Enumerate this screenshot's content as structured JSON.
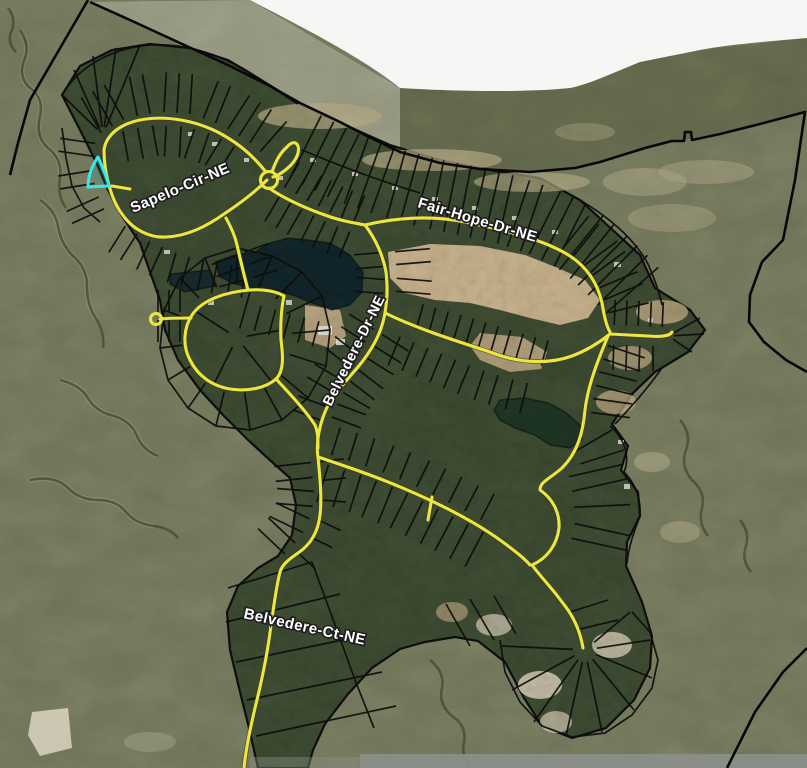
{
  "map": {
    "kind": "aerial-parcel-map",
    "labels": {
      "sapelo": "Sapelo-Cir-NE",
      "fair_hope": "Fair-Hope-Dr-NE",
      "belvedere_dr": "Belvedere-Dr-NE",
      "belvedere_ct": "Belvedere-Ct-NE"
    },
    "highlight": {
      "name": "selected-parcel",
      "color": "#3AE8E6"
    },
    "colors": {
      "marsh": "#71755A",
      "tidal_flat": "#95977F",
      "water_band": "#62664A",
      "open_water": "#FBFCFA",
      "forest": "#3B4930",
      "sand": "#C9B189",
      "beach": "#B0A57F",
      "pond": "#0F2328",
      "pond_south": "#1C3322",
      "road": "#ECE63F",
      "parcel_line": "#0D0D0D",
      "label_text": "#FFFFFF"
    }
  }
}
